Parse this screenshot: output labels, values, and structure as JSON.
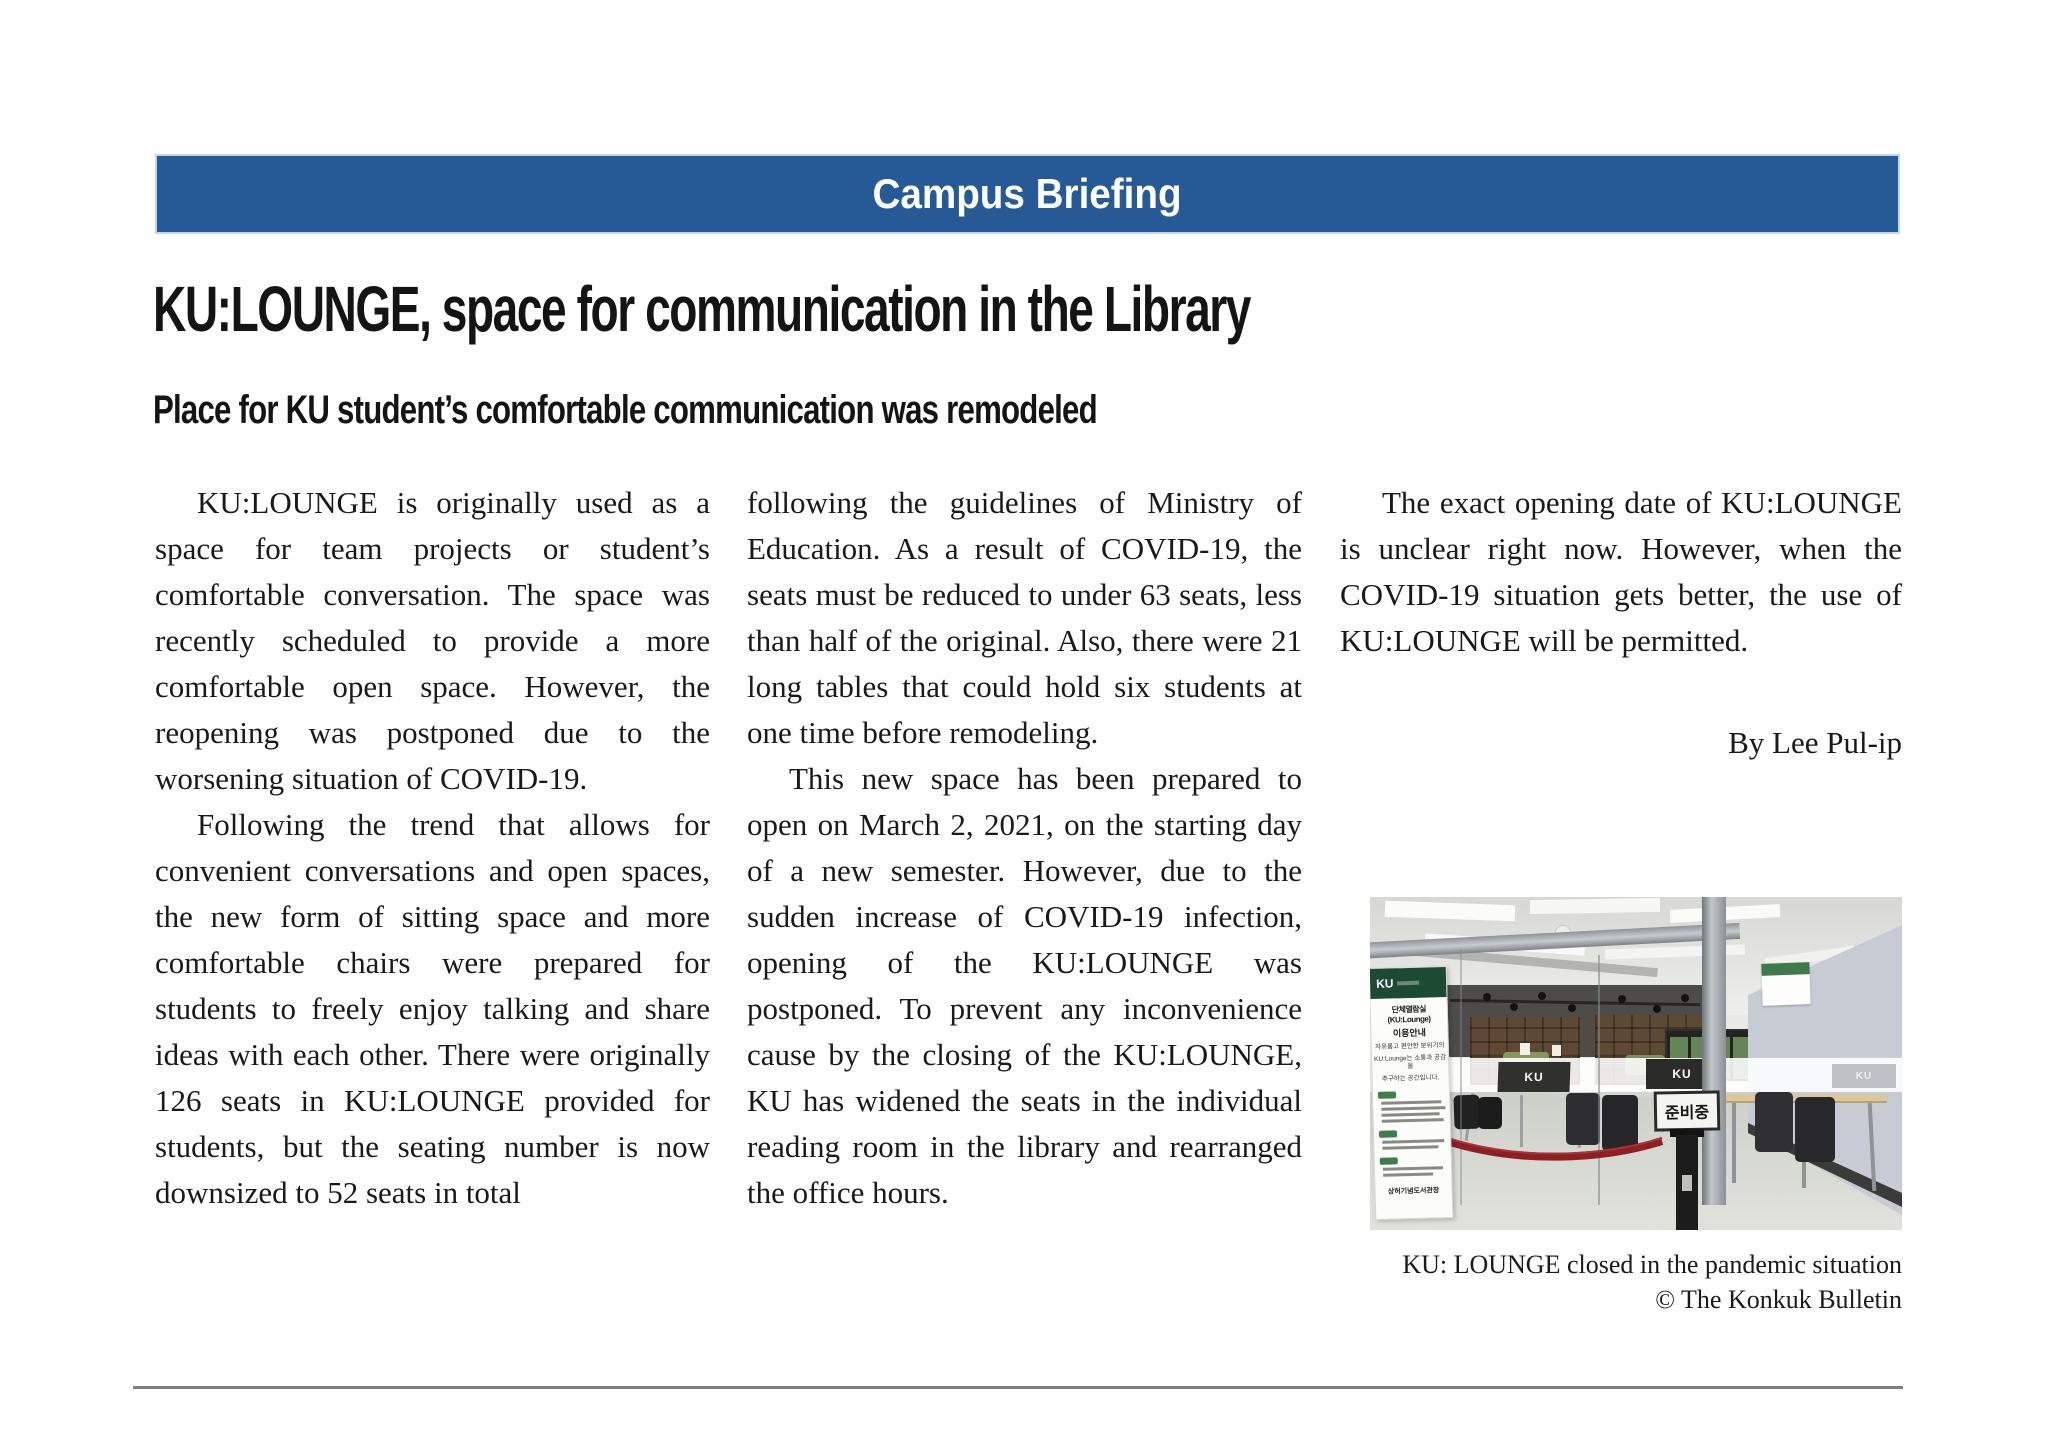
{
  "banner": {
    "label": "Campus Briefing",
    "bg_color": "#265a97"
  },
  "headline": "KU:LOUNGE, space for communication in the Library",
  "subheadline": "Place for KU student’s comfortable communication was remodeled",
  "article": {
    "col1_p1": "KU:LOUNGE is originally used as a space for team projects or student’s comfortable conversation. The space was recently scheduled to provide a more comfortable open space. However, the reopening was postponed due to the worsening situation of COVID-19.",
    "col1_p2": "Following the trend that allows for convenient conversations and open spaces, the new form of sitting space and more comfortable chairs were prepared for students to freely enjoy talking and share ideas with each other. There were originally 126 seats in KU:LOUNGE provided for students, but the seating number is now downsized to 52 seats in total",
    "col2_p1": "following the guidelines of Ministry of Education. As a result of COVID-19, the seats must be reduced to under 63 seats, less than half of the original. Also, there were 21 long tables that could hold six students at one time before remodeling.",
    "col2_p2": "This new space has been prepared to open on March 2, 2021, on the starting day of a new semester. However, due to the sudden increase of COVID-19 infection, opening of the KU:LOUNGE was postponed. To prevent any inconvenience cause by the closing of the KU:LOUNGE, KU has widened the seats in the individual reading room in the library and rearranged the office hours.",
    "col3_p1": "The exact opening date of KU:LOUNGE is unclear right now. However, when the COVID-19 situation gets better, the use of KU:LOUNGE will be permitted.",
    "byline": "By Lee Pul-ip"
  },
  "photo": {
    "caption_line1": "KU: LOUNGE closed in the pandemic situation",
    "caption_line2": "© The Konkuk Bulletin",
    "standby_sign": "준비중",
    "glass_sign_label": "KU",
    "poster": {
      "logo": "KU",
      "title": "단체열람실(KU:Lounge)",
      "subtitle": "이용안내",
      "intro_line1": "자유롭고 편안한 분위기의",
      "intro_line2": "KU:Lounge는 소통과 공감을",
      "intro_line3": "추구하는 공간입니다.",
      "footer": "상허기념도서관장"
    }
  }
}
